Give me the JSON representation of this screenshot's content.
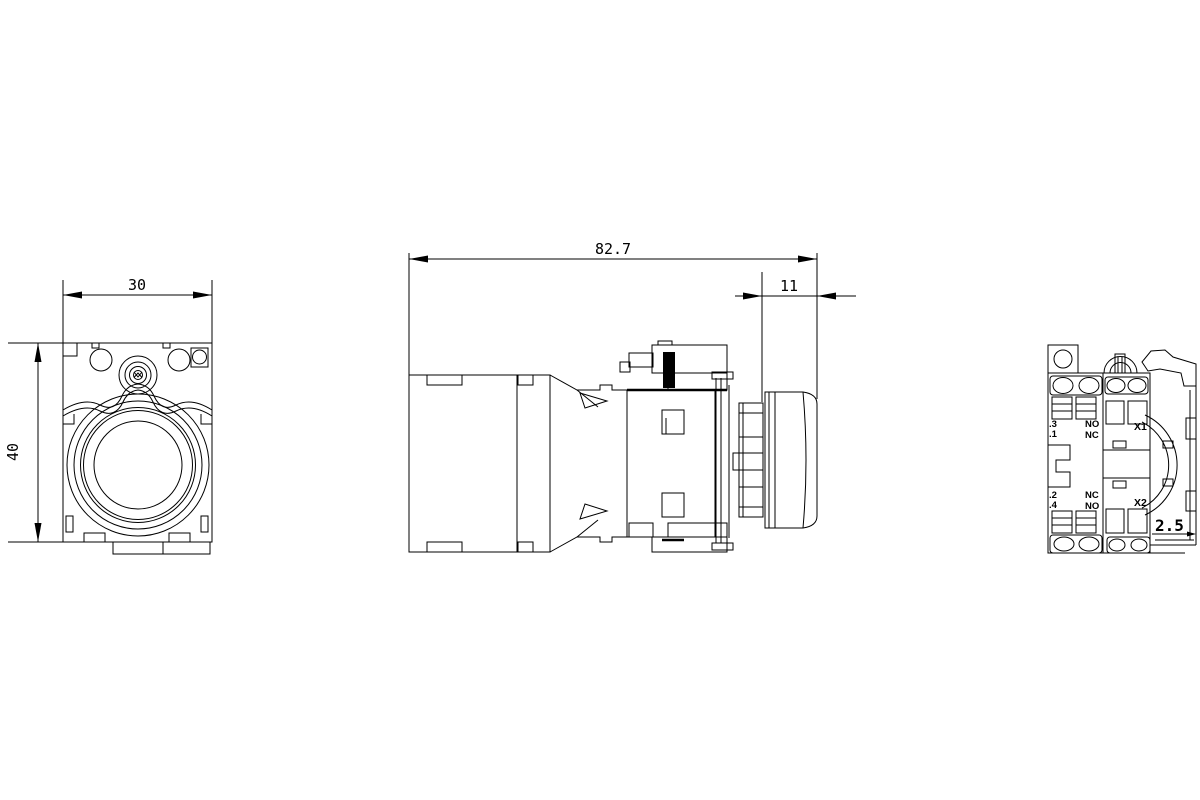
{
  "front_view": {
    "width_dim": "30",
    "height_dim": "40"
  },
  "side_view": {
    "overall_length_dim": "82.7",
    "cap_length_dim": "11"
  },
  "rear_view": {
    "terminal_labels": {
      "top": [
        ".3",
        ".1"
      ],
      "bottom": [
        ".2",
        ".4"
      ]
    },
    "contact_labels": {
      "top": [
        "NO",
        "NC"
      ],
      "bottom": [
        "NC",
        "NO"
      ]
    },
    "lamp_terminals": [
      "X1",
      "X2"
    ],
    "depth_dim": "2.5"
  },
  "colors": {
    "line": "#000000",
    "background": "#ffffff"
  }
}
